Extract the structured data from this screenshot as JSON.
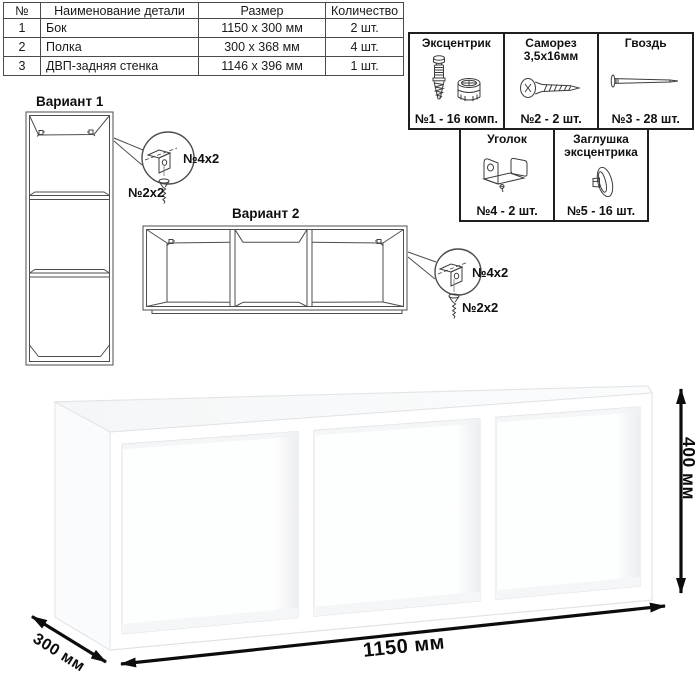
{
  "table": {
    "headers": [
      "№",
      "Наименование детали",
      "Размер",
      "Количество"
    ],
    "rows": [
      {
        "num": "1",
        "name": "Бок",
        "size": "1150 x 300 мм",
        "qty": "2 шт."
      },
      {
        "num": "2",
        "name": "Полка",
        "size": "300 x 368 мм",
        "qty": "4 шт."
      },
      {
        "num": "3",
        "name": "ДВП-задняя стенка",
        "size": "1146 x 396 мм",
        "qty": "1 шт."
      }
    ]
  },
  "hardware": {
    "items": [
      {
        "name": "Эксцентрик",
        "count": "№1 - 16 комп.",
        "icon": "cam-bolt-icon"
      },
      {
        "name": "Саморез 3,5х16мм",
        "count": "№2 - 2 шт.",
        "icon": "screw-icon"
      },
      {
        "name": "Гвоздь",
        "count": "№3 - 28 шт.",
        "icon": "nail-icon"
      },
      {
        "name": "Уголок",
        "count": "№4 - 2 шт.",
        "icon": "corner-bracket-icon"
      },
      {
        "name": "Заглушка эксцентрика",
        "count": "№5 - 16 шт.",
        "icon": "cam-cap-icon"
      }
    ]
  },
  "variants": {
    "v1": {
      "label": "Вариант 1",
      "callout_bracket": "№4х2",
      "callout_screw": "№2х2"
    },
    "v2": {
      "label": "Вариант 2",
      "callout_bracket": "№4х2",
      "callout_screw": "№2х2"
    }
  },
  "dimensions": {
    "width": "1150 мм",
    "height": "400 мм",
    "depth": "300 мм"
  },
  "colors": {
    "line_art": "#4d4d4d",
    "dimension": "#0b0b0b",
    "border": "#1f1f1f",
    "shading": "#eef0f2"
  }
}
